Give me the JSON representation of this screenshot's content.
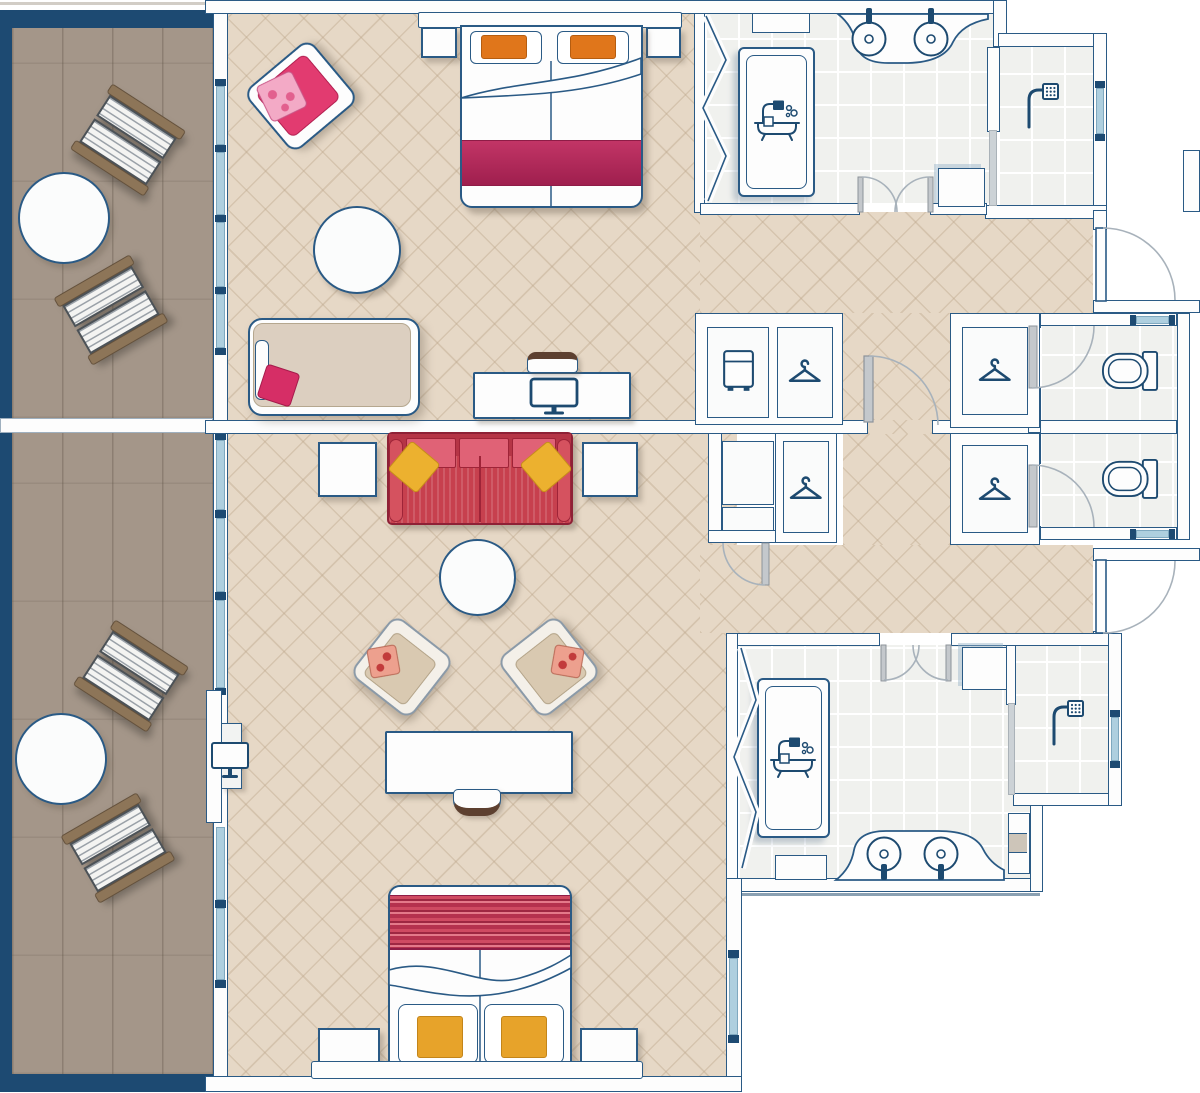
{
  "palette": {
    "wall_line": "#2a5a85",
    "wall_dark": "#1d4a72",
    "glass": "#aecfdf",
    "floor_room": "#e6d8c6",
    "floor_wood": "#a49689",
    "floor_bath": "#f0f1ee",
    "icon_blue": "#1d4a70",
    "arc_gray": "#a8b2bb",
    "magenta": "#b72a5e",
    "pink": "#e23b70",
    "sofa_red": "#c7404e",
    "cushion_red": "#e06276",
    "yellow": "#ecb12f",
    "orange": "#e0761b",
    "gold": "#e7a32a",
    "beige_furn": "#d9c9b1",
    "wood_trim": "#8d7558"
  },
  "plan": {
    "type": "hotel-suite-floor-plan",
    "balconies": [
      {
        "id": "balcony-upper",
        "floor": "wood-deck",
        "furniture": [
          "sun-lounger",
          "sun-lounger",
          "patio-table"
        ]
      },
      {
        "id": "balcony-lower",
        "floor": "wood-deck",
        "furniture": [
          "sun-lounger",
          "sun-lounger",
          "patio-table"
        ]
      }
    ],
    "rooms": [
      {
        "id": "bedroom-upper",
        "floor": "tile-lattice",
        "furniture": [
          "double-bed",
          "headboard",
          "nightstand",
          "nightstand",
          "pink-armchair",
          "round-ottoman",
          "daybed",
          "desk",
          "desk-stool",
          "monitor"
        ]
      },
      {
        "id": "living-bedroom-lower",
        "floor": "tile-lattice",
        "furniture": [
          "red-sofa",
          "side-table",
          "side-table",
          "round-coffee-table",
          "beige-armchair",
          "beige-armchair",
          "tv-unit",
          "table",
          "stool",
          "double-bed",
          "headboard",
          "nightstand",
          "nightstand"
        ]
      }
    ],
    "bathrooms": [
      {
        "id": "bathroom-upper",
        "fixtures": [
          "bathtub",
          "double-sink-counter",
          "wall-cabinet",
          "shelf",
          "double-swing-doors",
          "accordion-partition"
        ]
      },
      {
        "id": "shower-room-upper",
        "fixtures": [
          "walk-in-shower",
          "glass-partition",
          "window"
        ]
      },
      {
        "id": "bathroom-lower",
        "fixtures": [
          "bathtub",
          "double-sink-counter",
          "wall-cabinet",
          "shelf",
          "storage-column",
          "double-swing-doors",
          "accordion-partition"
        ]
      },
      {
        "id": "shower-room-lower",
        "fixtures": [
          "walk-in-shower",
          "glass-partition",
          "window"
        ]
      },
      {
        "id": "wc-upper",
        "fixtures": [
          "toilet",
          "window",
          "door"
        ]
      },
      {
        "id": "wc-lower",
        "fixtures": [
          "toilet",
          "window",
          "door"
        ]
      }
    ],
    "closets": [
      {
        "id": "closet-upper-left",
        "contents": [
          "minibar",
          "hanger"
        ]
      },
      {
        "id": "closet-upper-right",
        "contents": [
          "hanger"
        ]
      },
      {
        "id": "closet-lower-left",
        "contents": [
          "shelves",
          "hanger"
        ]
      },
      {
        "id": "closet-lower-right",
        "contents": [
          "hanger"
        ]
      }
    ],
    "doors": [
      "entry-door-upper",
      "entry-door-lower",
      "connecting-door",
      "wc-door-upper",
      "wc-door-lower",
      "closet-door"
    ],
    "icons": [
      "bathtub-icon",
      "shower-icon",
      "sink-icon",
      "toilet-icon",
      "hanger-icon",
      "minibar-icon",
      "monitor-icon",
      "tv-icon"
    ]
  }
}
